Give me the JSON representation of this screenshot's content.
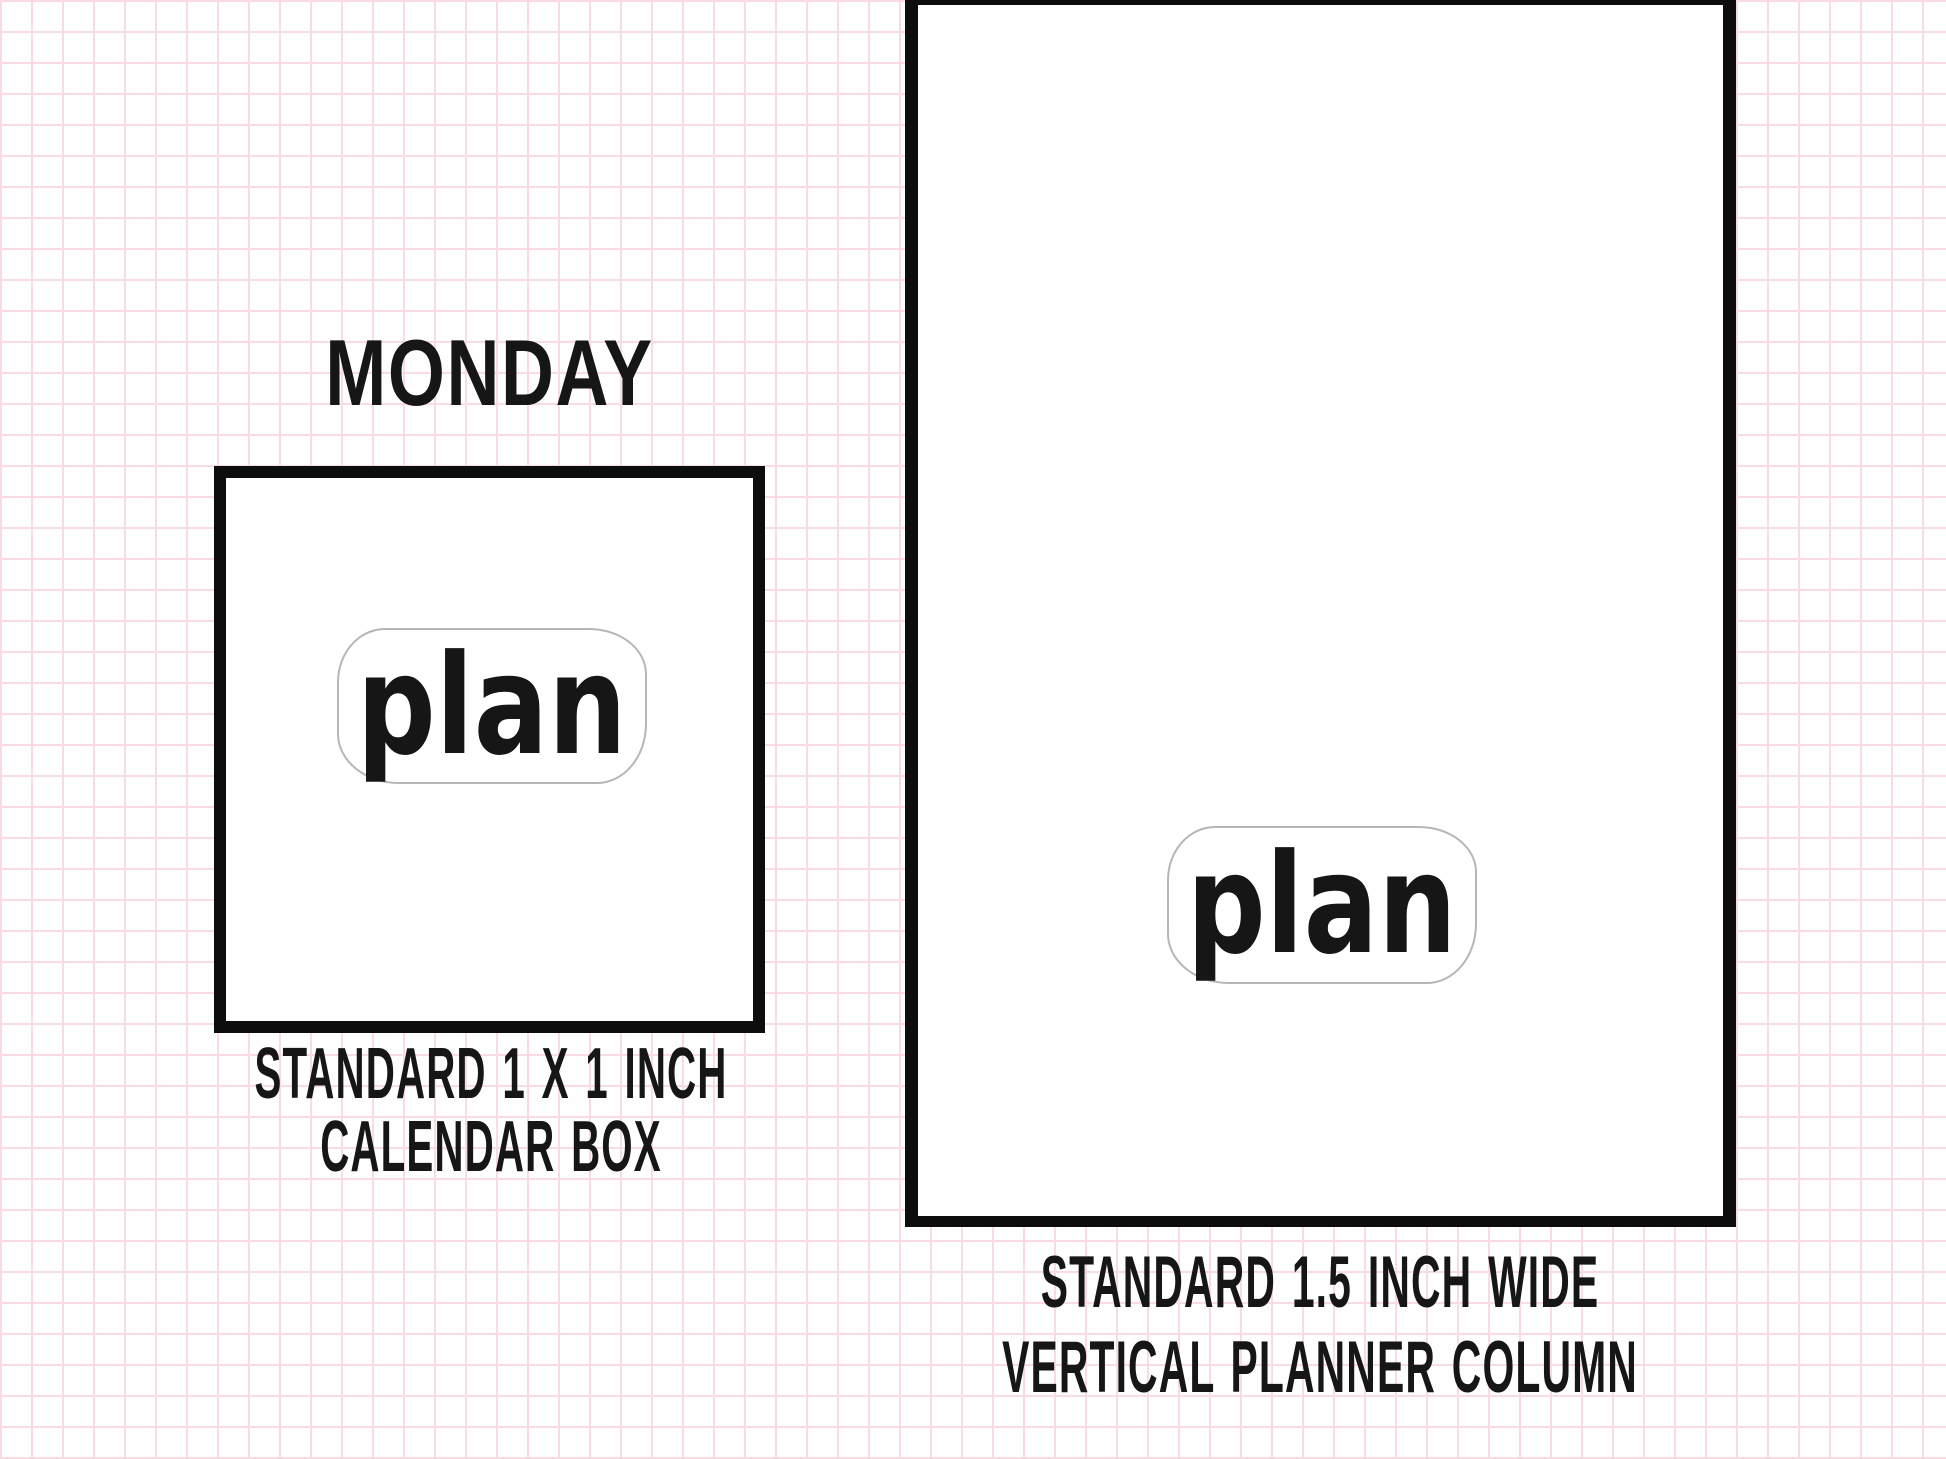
{
  "colors": {
    "ink": "#161616",
    "box_border": "#0d0d0d",
    "sticker_outline": "#b6b6b6",
    "sticker_fill": "#ffffff",
    "grid_line": "#f9dbe3",
    "background": "#fffefe"
  },
  "left_example": {
    "header": "MONDAY",
    "sticker_label": "plan",
    "caption": [
      "STANDARD 1 X 1 INCH",
      "CALENDAR BOX"
    ]
  },
  "right_example": {
    "sticker_label": "plan",
    "caption": [
      "STANDARD 1.5 INCH WIDE",
      "VERTICAL PLANNER COLUMN"
    ]
  }
}
